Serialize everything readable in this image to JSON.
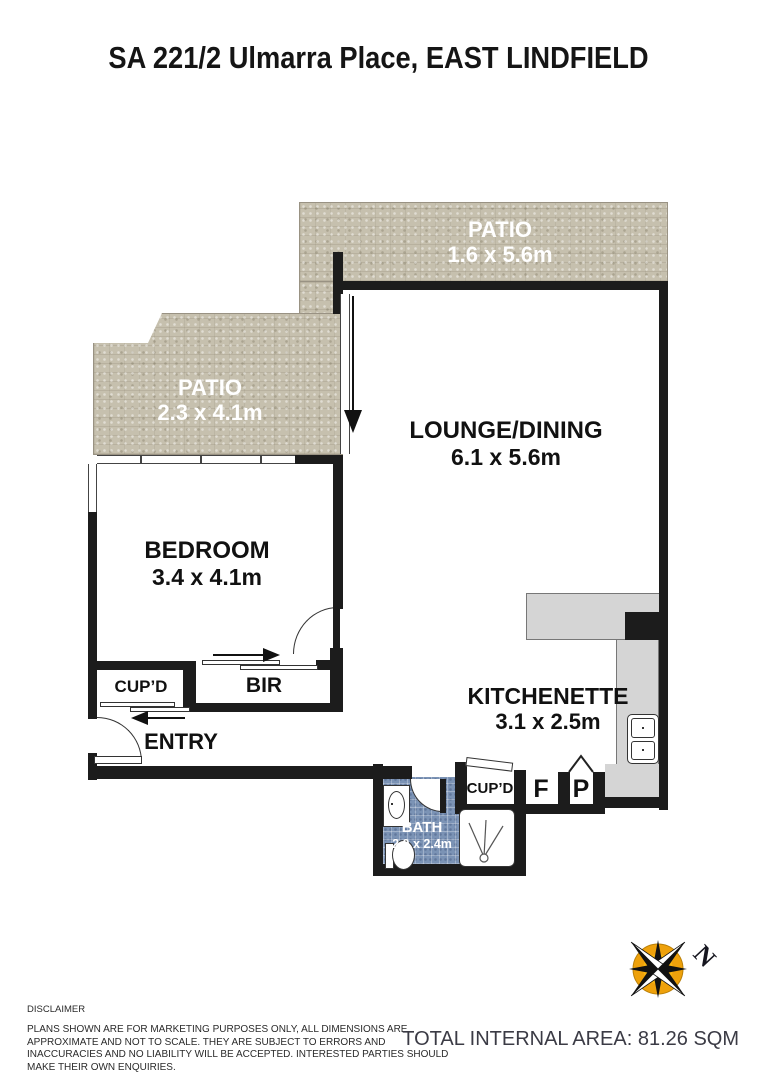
{
  "title": "SA 221/2 Ulmarra Place, EAST LINDFIELD",
  "rooms": {
    "patio_top": {
      "name": "PATIO",
      "dims": "1.6 x 5.6m"
    },
    "patio_left": {
      "name": "PATIO",
      "dims": "2.3 x 4.1m"
    },
    "lounge": {
      "name": "LOUNGE/DINING",
      "dims": "6.1 x 5.6m"
    },
    "bedroom": {
      "name": "BEDROOM",
      "dims": "3.4 x 4.1m"
    },
    "kitchenette": {
      "name": "KITCHENETTE",
      "dims": "3.1 x 2.5m"
    },
    "bath": {
      "name": "BATH",
      "dims": "2.0 x 2.4m"
    },
    "cupboard_hall": {
      "name": "CUP’D"
    },
    "bir": {
      "name": "BIR"
    },
    "entry": {
      "name": "ENTRY"
    },
    "cupboard_kitchen": {
      "name": "CUP’D"
    },
    "fridge": {
      "name": "F"
    },
    "pantry": {
      "name": "P"
    }
  },
  "compass": {
    "north_label": "N"
  },
  "footer": {
    "disclaimer_title": "DISCLAIMER",
    "disclaimer_body": "PLANS SHOWN ARE FOR MARKETING PURPOSES ONLY, ALL DIMENSIONS ARE APPROXIMATE AND NOT TO SCALE. THEY ARE SUBJECT TO ERRORS AND INACCURACIES AND NO LIABILITY WILL BE ACCEPTED. INTERESTED PARTIES SHOULD MAKE THEIR OWN ENQUIRIES.",
    "total_area": "TOTAL INTERNAL AREA: 81.26 SQM"
  },
  "colors": {
    "wall": "#1c1c1c",
    "patio": "#c6c0ae",
    "bath_tile": "#7b93b5",
    "counter": "#d5d5d5",
    "compass_orange": "#eea10b"
  }
}
